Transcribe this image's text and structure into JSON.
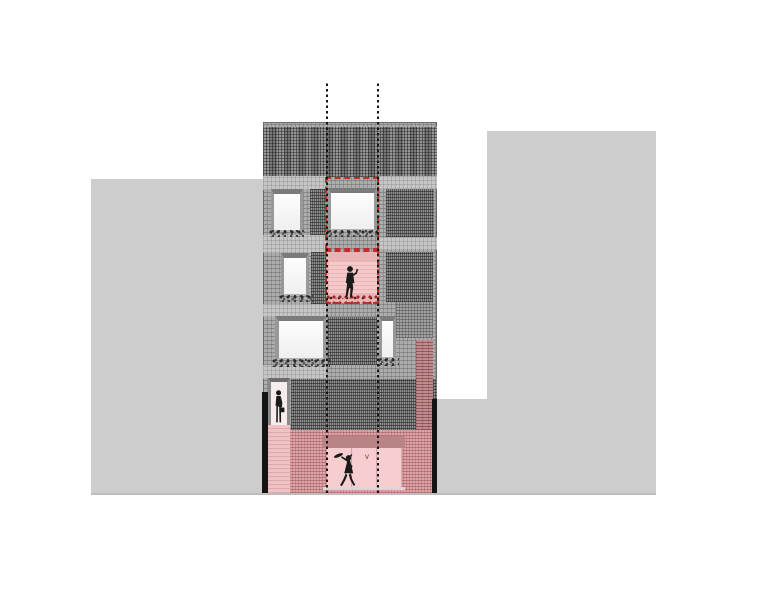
{
  "drawing": {
    "annotation_mark": "v",
    "colors": {
      "canvas_bg": "#ffffff",
      "neighbor_building": "#cdcdcd",
      "facade_base": "#adadad",
      "facade_dark_patch": "#8a8a8a",
      "facade_light_band": "#c6c6c6",
      "window_glass": "#efefef",
      "window_frame": "#7b7b7b",
      "highlight_dash_red": "#c42b2b",
      "loggia_pink": "#f5c9ca",
      "opening_header_mauve": "#b98486",
      "ground_wall_pink": "#dda4a7",
      "ground_opening_pink": "#f7cecf",
      "side_strip_pink": "#c28b8e",
      "party_wall_black": "#141414",
      "axis_dotted_black": "#151515",
      "figure_black": "#1a1a1a",
      "flower_red": "#9e2b2b",
      "plant_dark": "#2b2b2b"
    },
    "icons": {
      "loggia_figure": "standing-man-icon",
      "door_figure": "man-with-bag-icon",
      "street_figure": "walking-woman-icon"
    }
  }
}
